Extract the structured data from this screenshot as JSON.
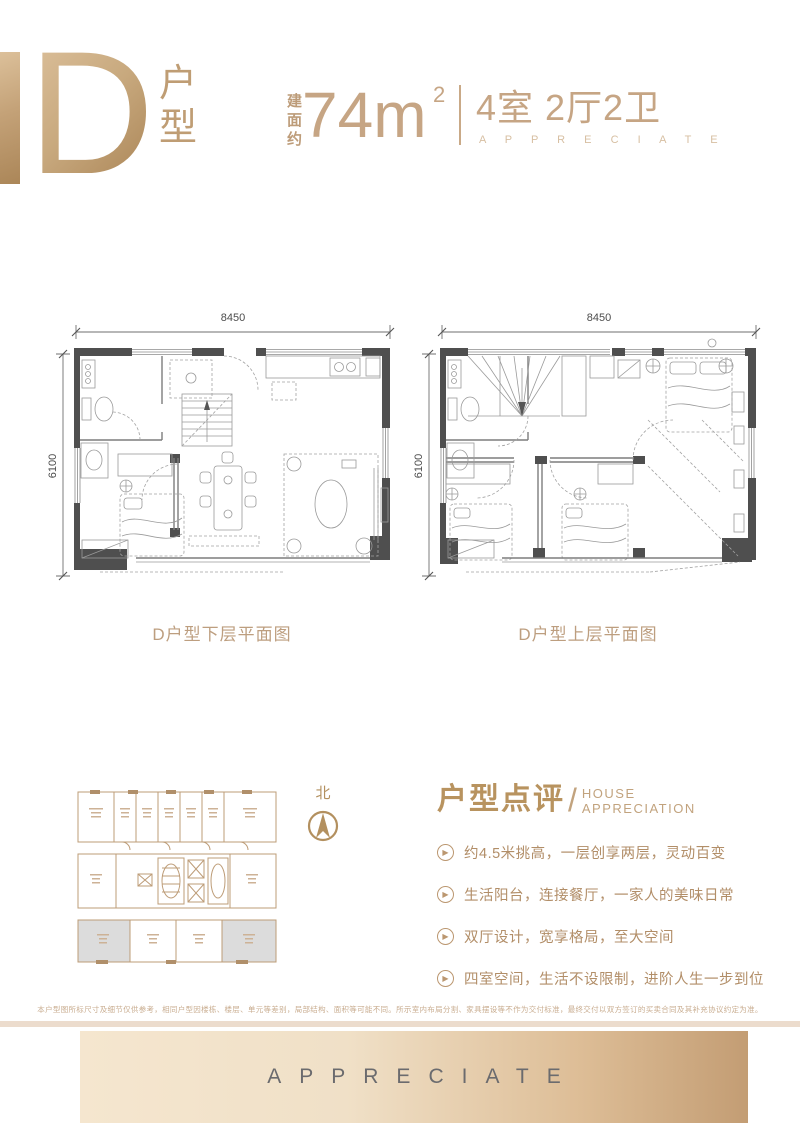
{
  "header": {
    "big_letter": "D",
    "type_label_char1": "户",
    "type_label_char2": "型",
    "area_prefix": "建面约",
    "area_value": "74m",
    "area_sup": "2",
    "rooms": "4室 2厅2卫",
    "rooms_sub": "A P P R E C I A T E"
  },
  "plans": {
    "width_dim": "8450",
    "height_dim": "6100",
    "lower_caption": "D户型下层平面图",
    "upper_caption": "D户型上层平面图"
  },
  "siteplan": {
    "north_label": "北"
  },
  "review": {
    "title_cn": "户型点评",
    "slash": "/",
    "title_en_line1": "HOUSE",
    "title_en_line2": "APPRECIATION",
    "play_icon": "▶",
    "points": [
      "约4.5米挑高，一层创享两层，灵动百变",
      "生活阳台，连接餐厅，一家人的美味日常",
      "双厅设计，宽享格局，至大空间",
      "四室空间，生活不设限制，进阶人生一步到位"
    ]
  },
  "disclaimer": "本户型图所标尺寸及细节仅供参考，相同户型因楼栋、楼层、单元等差别，局部结构、面积等可能不同。所示室内布局分割、家具摆设等不作为交付标准，最终交付以双方签订的买卖合同及其补充协议约定为准。",
  "banner": {
    "text": "APPRECIATE"
  },
  "colors": {
    "accent_gold": "#c2a07e",
    "wall_gray": "#4f4f4f",
    "highlight_unit_gray": "#dcdcdc",
    "banner_left": "#f5e6cf",
    "banner_right": "#c39d74"
  }
}
